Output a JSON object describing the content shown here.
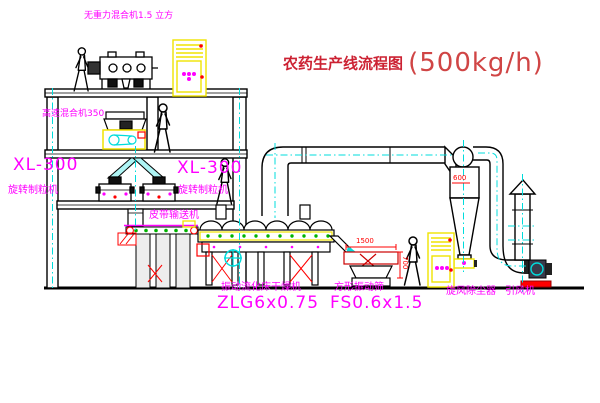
{
  "title": {
    "text": "农药生产线流程图",
    "capacity": "(500kg/h)"
  },
  "equipment_labels": {
    "gravity_free_mixer": "无重力混合机1.5 立方",
    "high_speed_mixer": "高速混合机350",
    "granulator_left": {
      "model": "XL-300",
      "name": "旋转制粒机"
    },
    "granulator_center": {
      "model": "XL-300",
      "name": "旋转制粒机"
    },
    "belt_conveyor": "皮带输送机",
    "fluid_bed_dryer": {
      "name": "振动流化床干燥机",
      "model": "ZLG6x0.75"
    },
    "square_sieve": {
      "name": "方形振动筛",
      "model": "FS0.6x1.5"
    },
    "cyclone_dust_collector": "旋风除尘器",
    "induced_draft_fan": "引风机"
  },
  "dimensions": {
    "cyclone_outlet": "600",
    "sieve_length": "1500",
    "sieve_height": "700"
  },
  "colors": {
    "title_red": "#cc2233",
    "label_magenta": "#ff00ff",
    "dimension_red": "#ff0000",
    "centerline_cyan": "#00dcdc",
    "equipment_yellow": "#f0e300",
    "dot_green": "#00b400",
    "line_black": "#000000"
  }
}
